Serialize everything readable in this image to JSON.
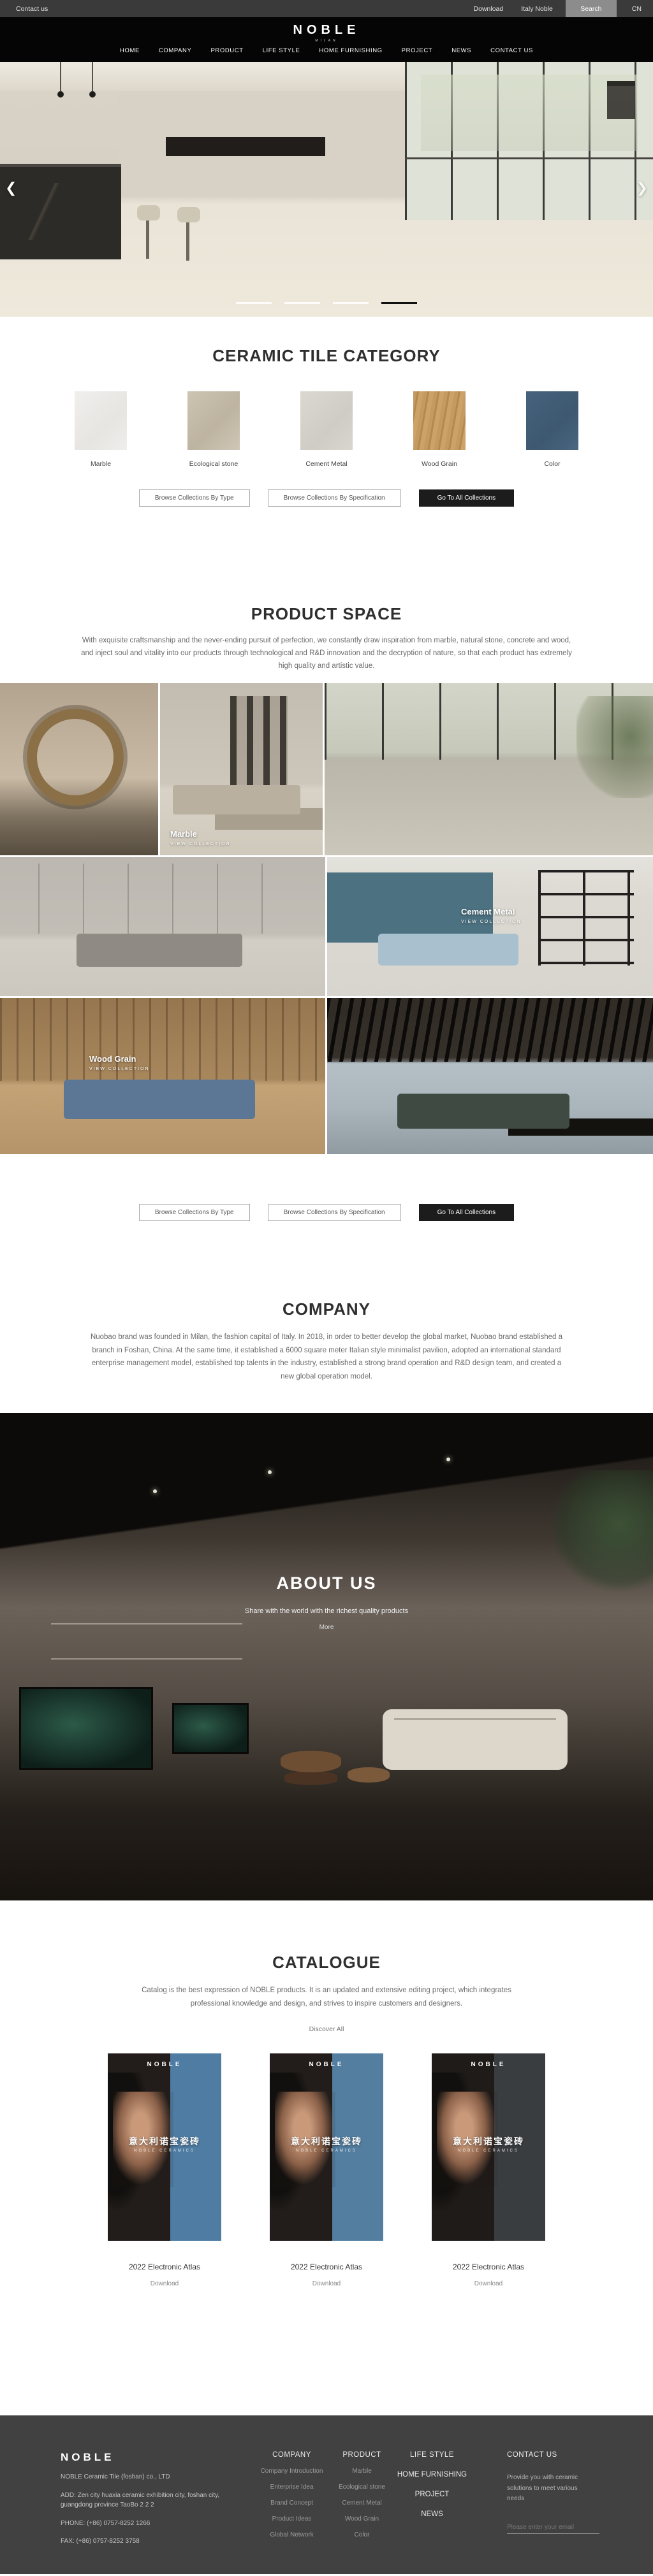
{
  "topbar": {
    "contact": "Contact us",
    "download": "Download",
    "italy": "Italy Noble",
    "search": "Search",
    "lang": "CN"
  },
  "header": {
    "logo": "NOBLE",
    "logo_sub": "MILAN",
    "nav": [
      "HOME",
      "COMPANY",
      "PRODUCT",
      "LIFE STYLE",
      "HOME FURNISHING",
      "PROJECT",
      "NEWS",
      "CONTACT US"
    ]
  },
  "hero": {
    "prev_icon": "❮",
    "next_icon": "❯"
  },
  "category": {
    "title": "CERAMIC TILE CATEGORY",
    "items": [
      {
        "label": "Marble",
        "color": "linear-gradient(135deg,#f0efed 0%,#e7e5e2 60%,#efeeec 100%)"
      },
      {
        "label": "Ecological stone",
        "color": "linear-gradient(135deg,#cdc4b3 0%,#bdb3a0 55%,#cfc6b6 100%)"
      },
      {
        "label": "Cement Metal",
        "color": "linear-gradient(135deg,#dbd8d1 0%,#cfccc5 60%,#d9d6cf 100%)"
      },
      {
        "label": "Wood Grain",
        "color": "repeating-linear-gradient(100deg,#c49a63 0 6px,#b3894f 6px 9px,#cda269 9px 16px)"
      },
      {
        "label": "Color",
        "color": "linear-gradient(135deg,#46627c 0%,#3d5870 60%,#4a6680 100%)"
      }
    ]
  },
  "collection_buttons": {
    "by_type": "Browse Collections By Type",
    "by_spec": "Browse Collections By Specification",
    "all": "Go To All Collections"
  },
  "product_space": {
    "title": "PRODUCT SPACE",
    "paragraph": "With exquisite craftsmanship and the never-ending pursuit of perfection, we constantly draw inspiration from marble, natural stone, concrete and wood, and inject soul and vitality into our products through technological and R&D innovation and the decryption of nature, so that each product has extremely high quality and artistic value."
  },
  "gallery": {
    "labels": [
      {
        "name": "Marble",
        "cta": "VIEW COLLECTION"
      },
      {
        "name": "Cement Metal",
        "cta": "VIEW COLLECTION"
      },
      {
        "name": "Wood Grain",
        "cta": "VIEW COLLECTION"
      }
    ]
  },
  "company": {
    "title": "COMPANY",
    "paragraph": "Nuobao brand was founded in Milan, the fashion capital of Italy. In 2018, in order to better develop the global market, Nuobao brand established a branch in Foshan, China. At the same time, it established a 6000 square meter Italian style minimalist pavilion, adopted an international standard enterprise management model, established top talents in the industry, established a strong brand operation and R&D design team, and created a new global operation model."
  },
  "about": {
    "title": "ABOUT US",
    "line": "Share with the world with the richest quality products",
    "more": "More"
  },
  "catalogue": {
    "title": "CATALOGUE",
    "paragraph": "Catalog is the best expression of NOBLE products. It is an updated and extensive editing project, which integrates professional knowledge and design, and strives to inspire customers and designers.",
    "discover": "Discover All",
    "covers": [
      {
        "brand": "NOBLE",
        "cn": "意大利诺宝瓷砖",
        "sub": "NOBLE CERAMICS",
        "panel": "linear-gradient(90deg,#221d1b 0 55%,#4e7ca3 55% 100%)"
      },
      {
        "brand": "NOBLE",
        "cn": "意大利诺宝瓷砖",
        "sub": "NOBLE CERAMICS",
        "panel": "linear-gradient(90deg,#221d1b 0 55%,#537ea0 55% 100%)"
      },
      {
        "brand": "NOBLE",
        "cn": "意大利诺宝瓷砖",
        "sub": "NOBLE CERAMICS",
        "panel": "linear-gradient(90deg,#1f1b19 0 55%,#3a3d40 55% 100%)"
      }
    ],
    "caption": "2022 Electronic Atlas",
    "download": "Download"
  },
  "footer": {
    "logo": "NOBLE",
    "company_name": "NOBLE Ceramic Tile (foshan) co., LTD",
    "address": "ADD:  Zen city huaxia ceramic exhibition city, foshan city, guangdong province TaoBo 2 2 2",
    "phone": "PHONE:   (+86)  0757-8252 1266",
    "fax": "FAX:   (+86)  0757-8252 3758",
    "col_company": {
      "title": "COMPANY",
      "items": [
        "Company Introduction",
        "Enterprise Idea",
        "Brand Concept",
        "Product Ideas",
        "Global Network"
      ]
    },
    "col_product": {
      "title": "PRODUCT",
      "items": [
        "Marble",
        "Ecological stone",
        "Cement Metal",
        "Wood Grain",
        "Color"
      ]
    },
    "col_nav": {
      "title": "LIFE STYLE",
      "items": [
        "HOME FURNISHING",
        "PROJECT",
        "NEWS"
      ]
    },
    "contact": {
      "title": "CONTACT US",
      "text": "Provide you with ceramic solutions to meet various needs",
      "email_placeholder": "Please enter your email"
    }
  }
}
